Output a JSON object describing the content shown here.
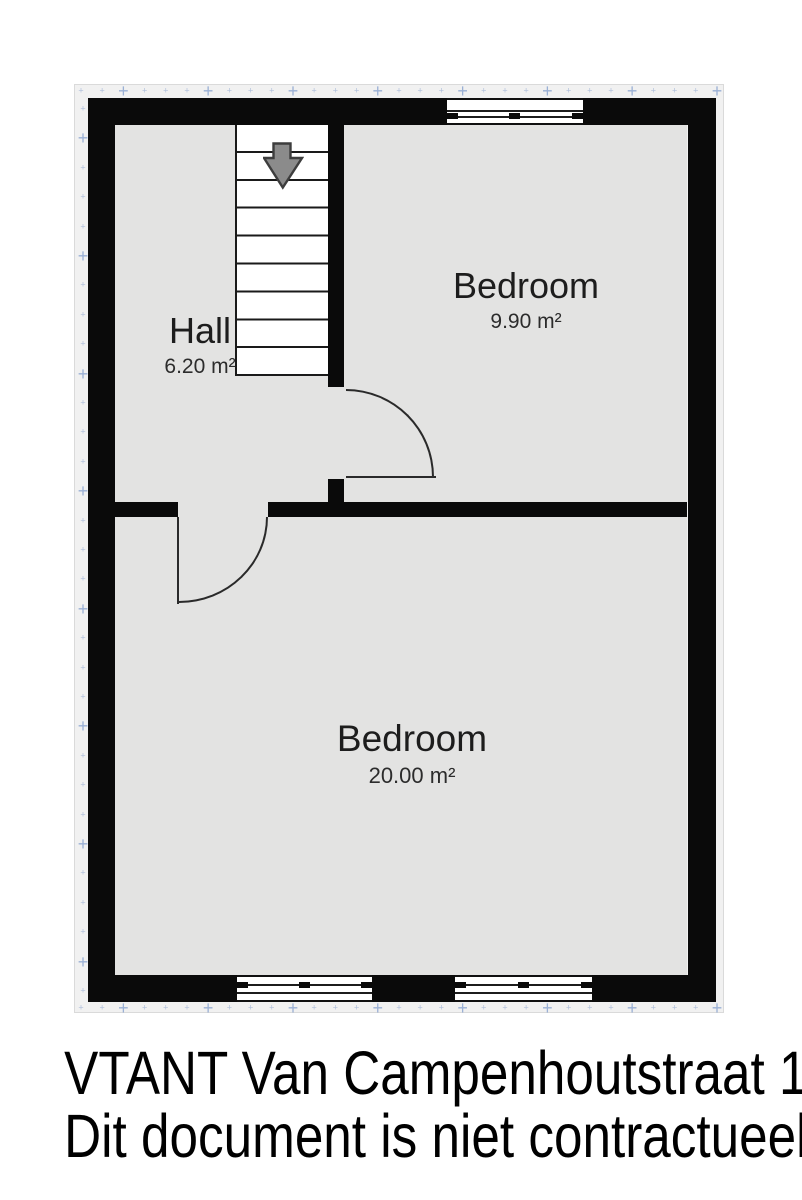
{
  "plan": {
    "rooms": [
      {
        "name": "Hall",
        "area": "6.20 m²"
      },
      {
        "name": "Bedroom",
        "area": "9.90 m²"
      },
      {
        "name": "Bedroom",
        "area": "20.00 m²"
      }
    ],
    "icons": {
      "stairs_direction": "down-arrow"
    },
    "colors": {
      "wall": "#0a0a0a",
      "floor": "#e3e3e2",
      "sheet": "#f1f1f1",
      "grid_mark": "#6c8ec6",
      "stairs_arrow_fill": "#8b8b8b"
    }
  },
  "caption": {
    "line1": "VTANT Van Campenhoutstraat 13",
    "line2": "Dit document is niet contractueel"
  }
}
